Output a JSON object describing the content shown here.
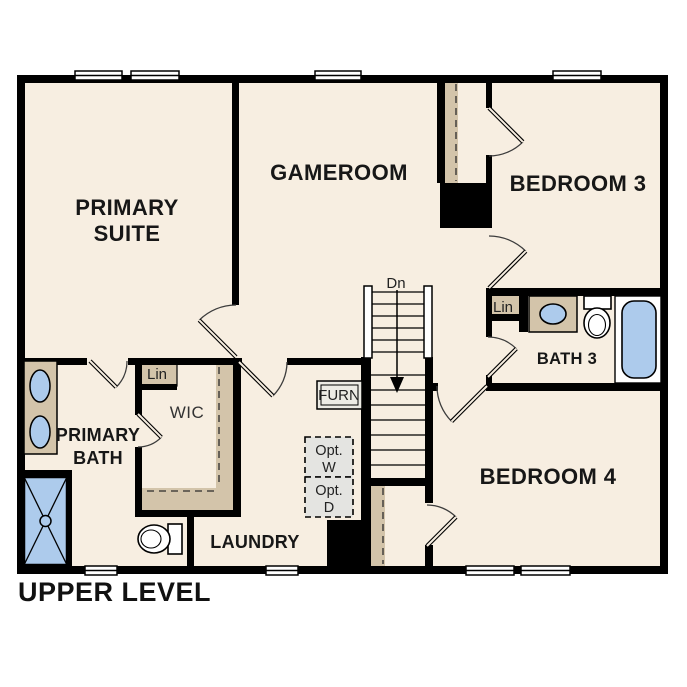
{
  "title": "UPPER LEVEL",
  "colors": {
    "background": "#ffffff",
    "floor": "#f7eee1",
    "wall": "#000000",
    "closet_tan": "#d3c4aa",
    "fixture_blue": "#adcbec",
    "optional_gray": "#e4e4e1",
    "furnace_fill": "#ecebe4"
  },
  "rooms": {
    "primary_suite": {
      "line1": "PRIMARY",
      "line2": "SUITE"
    },
    "gameroom": {
      "label": "GAMEROOM"
    },
    "bedroom_3": {
      "label": "BEDROOM 3"
    },
    "bath_3": {
      "label": "BATH 3"
    },
    "bedroom_4": {
      "label": "BEDROOM 4"
    },
    "primary_bath": {
      "line1": "PRIMARY",
      "line2": "BATH"
    },
    "wic": {
      "label": "WIC"
    },
    "laundry": {
      "label": "LAUNDRY"
    }
  },
  "annotations": {
    "stairs_direction": "Dn",
    "furnace": "FURN",
    "optional_washer": {
      "line1": "Opt.",
      "line2": "W"
    },
    "optional_dryer": {
      "line1": "Opt.",
      "line2": "D"
    },
    "linen_primary": "Lin",
    "linen_bath3": "Lin"
  }
}
